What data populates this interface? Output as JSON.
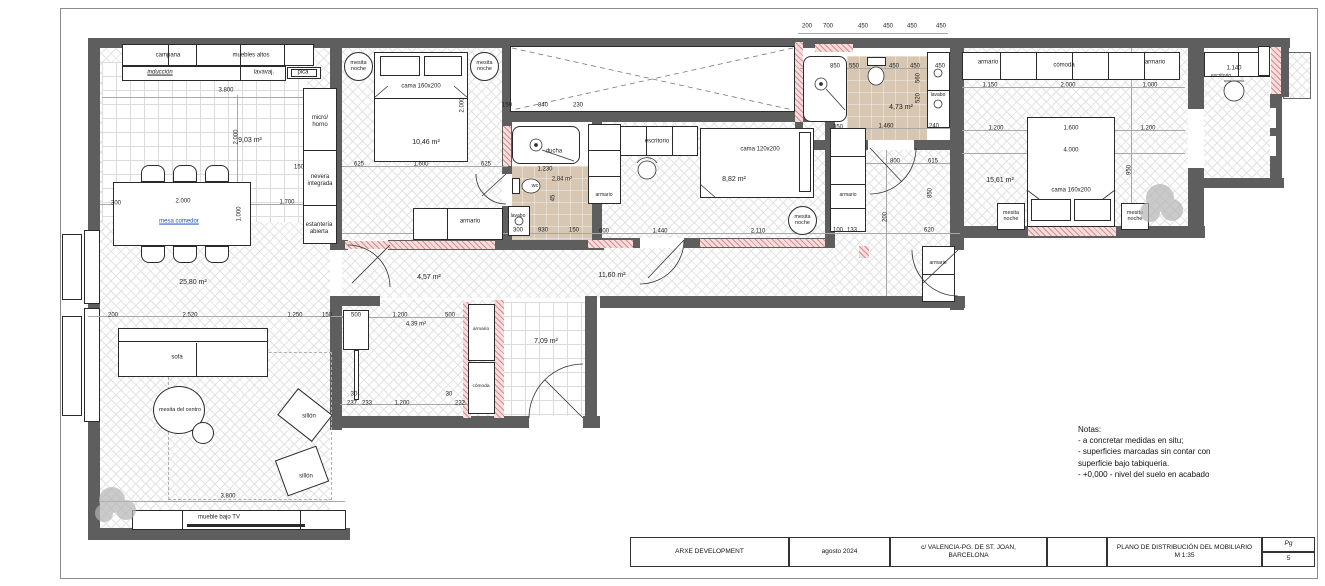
{
  "sheet": {
    "page_label": "Pg",
    "page_number": "5"
  },
  "title_block": {
    "developer": "ARXE DEVELOPMENT",
    "date": "agosto 2024",
    "address": "c/ VALENCIA-PG. DE ST. JOAN,\nBARCELONA",
    "title": "PLANO DE DISTRIBUCIÓN DEL MOBILIARIO",
    "scale": "M 1:35"
  },
  "notes": {
    "heading": "Notas:",
    "line1": "- a concretar medidas en situ;",
    "line2": "- superficies marcadas sin contar con",
    "line3": "superficie bajo tabiqueria.",
    "line4": "- +0,000 - nivel del suelo en acabado"
  },
  "top_dims": [
    "200",
    "700",
    "450",
    "450",
    "450",
    "450"
  ],
  "kitchen": {
    "campana": "campana",
    "muebles_altos": "muebles altos",
    "induccion": "inducción",
    "lavavajillas": "lavavaj.",
    "pica": "pica",
    "micro": "micro/\nhorno",
    "nevera": "nevera\nintegrada",
    "estanteria": "estantería\nabierta",
    "area": "9,03 m²",
    "d_width": "3.800",
    "d_depth": "2.000",
    "d_150": "150"
  },
  "dining": {
    "mesa": "mesa comedor",
    "area": "25,80 m²",
    "d_300": "300",
    "d_2000": "2.000",
    "d_1700": "1.700",
    "d_1000": "1.000"
  },
  "living": {
    "sofa": "sofa",
    "mesita": "mesita del centro",
    "sillon": "sillón",
    "mueble_tv": "mueble bajo TV",
    "d_200": "200",
    "d_2520": "2.520",
    "d_1250": "1.250",
    "d_150": "150",
    "d_3800": "3.800"
  },
  "bedroom1": {
    "mesita": "mesita\nnoche",
    "cama": "cama 160x200",
    "area": "10,46 m²",
    "armario": "armario",
    "d_2000": "2.000",
    "d_625a": "625",
    "d_1600": "1.600",
    "d_625b": "625"
  },
  "bath1": {
    "ducha": "ducha",
    "wc": "wc",
    "lavabo": "lavabo",
    "area": "2,84 m²",
    "d_1230": "1.230",
    "d_45": "45",
    "d_300": "300",
    "d_930": "930",
    "d_150": "150"
  },
  "patio": {
    "d_150": "150",
    "d_840": "840",
    "d_230": "230"
  },
  "bedroom2": {
    "escritorio": "escritorio",
    "armario_izq": "armario",
    "armario_der": "armario",
    "cama": "cama 120x200",
    "area": "8,82 m²",
    "mesita": "mesita\nnoche"
  },
  "corridor": {
    "area_a": "4,57 m²",
    "area_b": "11,60 m²",
    "d_600": "600",
    "d_1440": "1.440",
    "d_2110": "2.110",
    "d_100": "100",
    "d_133": "133",
    "d_620": "620"
  },
  "bath2": {
    "lavabo": "lavabo",
    "area": "4,73 m²",
    "d_850": "850",
    "d_550": "550",
    "d_450a": "450",
    "d_450b": "450",
    "d_450c": "450",
    "d_560": "560",
    "d_520": "520",
    "d_1460": "1.460",
    "d_350": "350",
    "d_240": "240",
    "d_800": "800",
    "d_615": "615"
  },
  "hall": {
    "armario": "armario",
    "d_850": "850",
    "d_200": "200"
  },
  "bedroom3": {
    "armario_izq": "armario",
    "comoda": "cómoda",
    "armario_der": "armario",
    "cama": "cama 160x200",
    "mesita": "mesita\nnoche",
    "area": "15,61 m²",
    "d_1150": "1.150",
    "d_2000": "2.000",
    "d_1000": "1.000",
    "d_1200a": "1.200",
    "d_1600": "1.600",
    "d_1200b": "1.200",
    "d_4000": "4.000",
    "d_950": "950"
  },
  "office": {
    "escritorio": "escritorio",
    "d_1140": "1.140"
  },
  "dressing": {
    "armario": "armario",
    "comoda": "cómoda",
    "area": "4,39 m²",
    "d_500a": "500",
    "d_1200a": "1.200",
    "d_500b": "500",
    "d_30a": "30",
    "d_237a": "237",
    "d_233": "233",
    "d_1200b": "1.200",
    "d_30b": "30",
    "d_232": "232"
  },
  "entry": {
    "area": "7,09 m²"
  }
}
